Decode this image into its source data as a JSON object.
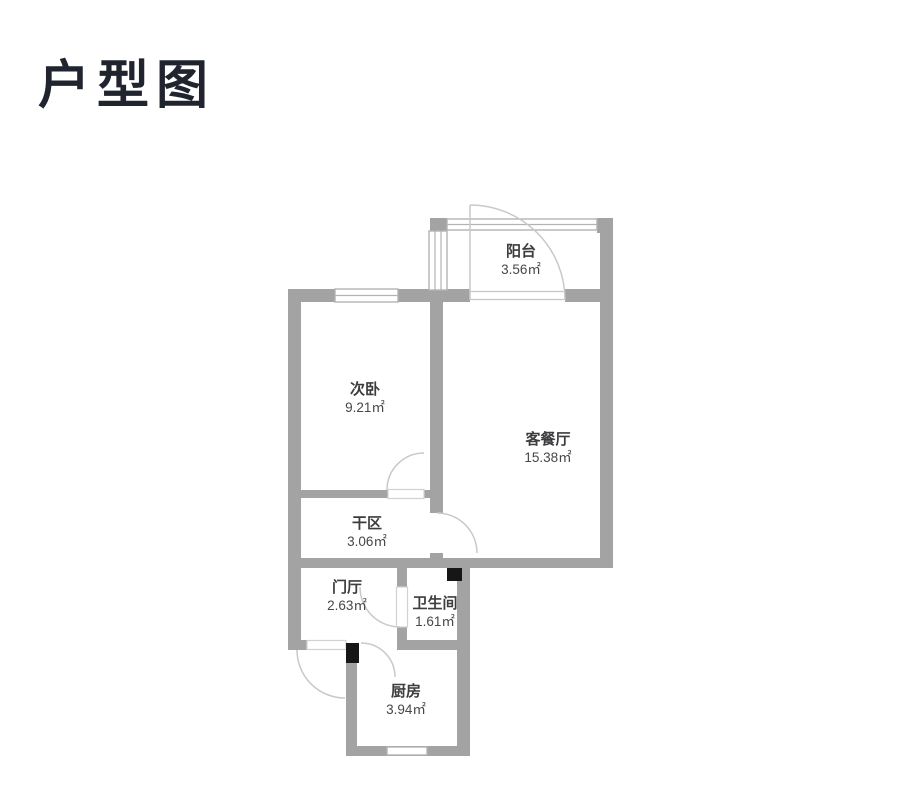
{
  "page": {
    "title": "户型图"
  },
  "floorplan": {
    "colors": {
      "wall": "#a3a3a4",
      "door_arc": "#c9c9ca",
      "pillar": "#161616",
      "label_text": "#3d3d3f",
      "title_text": "#20242f",
      "background": "#ffffff"
    },
    "rooms": [
      {
        "id": "balcony",
        "name": "阳台",
        "area": "3.56㎡"
      },
      {
        "id": "second-bedroom",
        "name": "次卧",
        "area": "9.21㎡"
      },
      {
        "id": "living-dining",
        "name": "客餐厅",
        "area": "15.38㎡"
      },
      {
        "id": "dry-area",
        "name": "干区",
        "area": "3.06㎡"
      },
      {
        "id": "entry-hall",
        "name": "门厅",
        "area": "2.63㎡"
      },
      {
        "id": "bathroom",
        "name": "卫生间",
        "area": "1.61㎡"
      },
      {
        "id": "kitchen",
        "name": "厨房",
        "area": "3.94㎡"
      }
    ]
  }
}
